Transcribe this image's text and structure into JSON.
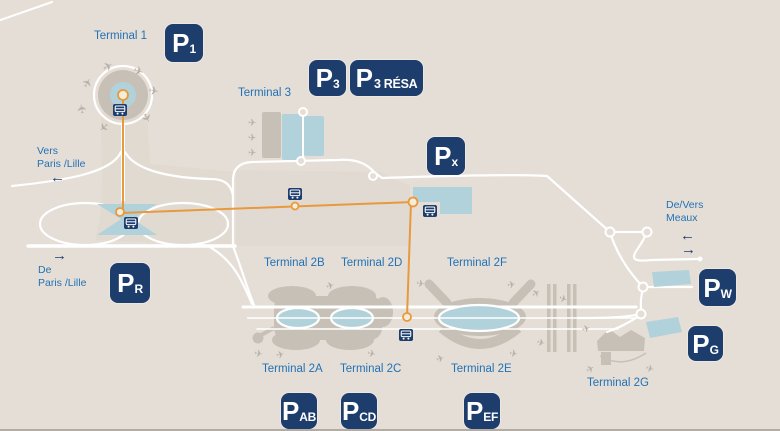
{
  "labels": {
    "terminal_1": "Terminal 1",
    "terminal_3": "Terminal 3",
    "terminal_2a": "Terminal 2A",
    "terminal_2b": "Terminal 2B",
    "terminal_2c": "Terminal 2C",
    "terminal_2d": "Terminal 2D",
    "terminal_2e": "Terminal 2E",
    "terminal_2f": "Terminal 2F",
    "terminal_2g": "Terminal 2G"
  },
  "directions": {
    "vers_paris_line1": "Vers",
    "vers_paris_line2": "Paris /Lille",
    "de_paris_line1": "De",
    "de_paris_line2": "Paris /Lille",
    "meaux_line1": "De/Vers",
    "meaux_line2": "Meaux",
    "arrow_left": "←",
    "arrow_right": "→"
  },
  "parkings": {
    "p1": {
      "main": "P",
      "sub": "1"
    },
    "p3": {
      "main": "P",
      "sub": "3"
    },
    "p3_resa": {
      "main": "P",
      "sub": "3 RÉSA"
    },
    "px": {
      "main": "P",
      "sub": "x"
    },
    "pr": {
      "main": "P",
      "sub": "R"
    },
    "pw": {
      "main": "P",
      "sub": "W"
    },
    "pg": {
      "main": "P",
      "sub": "G"
    },
    "pab": {
      "main": "P",
      "sub": "AB"
    },
    "pcd": {
      "main": "P",
      "sub": "CD"
    },
    "pef": {
      "main": "P",
      "sub": "EF"
    }
  },
  "icons": {
    "airplane": "✈"
  },
  "colors": {
    "background": "#e5ded6",
    "terminal_gray": "#c6c0b7",
    "area_blue": "#b2d2db",
    "badge_navy": "#1d3d6d",
    "label_blue": "#2272b5",
    "cdgval_orange": "#e8993d",
    "road_white": "#ffffff"
  }
}
